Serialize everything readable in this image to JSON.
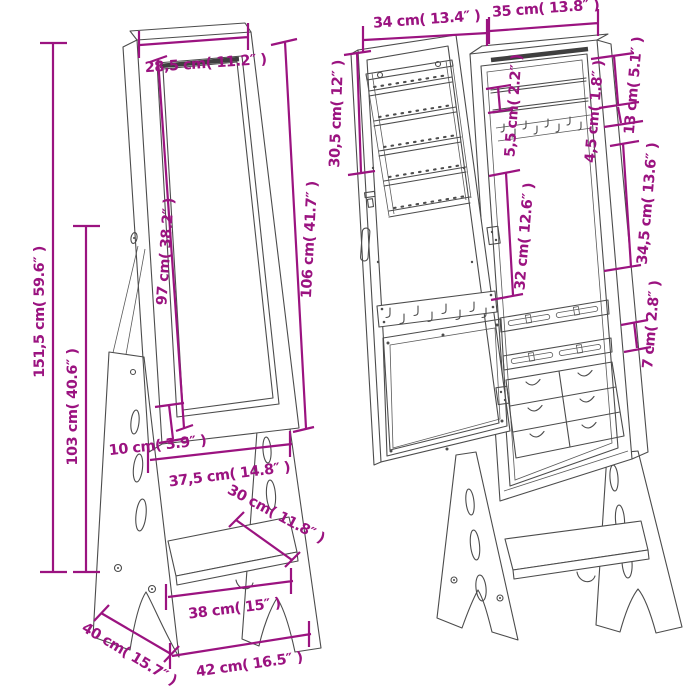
{
  "diagram": {
    "description": "Free-standing jewellery cabinet with mirror — dimension drawing, front view and open view",
    "colors": {
      "dimension": "#9b1380",
      "line": "#4c4c4c",
      "background": "#ffffff"
    },
    "front_view": {
      "top_width": "28,5 cm( 11.2″ )",
      "mirror_height": "97 cm( 38.2″ )",
      "cabinet_height": "106 cm( 41.7″ )",
      "total_height": "151,5 cm( 59.6″ )",
      "stand_height": "103 cm( 40.6″ )",
      "base_clearance": "10 cm( 3.9″ )",
      "lower_width": "37,5 cm( 14.8″ )",
      "shelf_depth": "30 cm( 11.8″ )",
      "shelf_width": "38 cm( 15″ )",
      "base_depth": "40 cm( 15.7″ )",
      "base_width": "42 cm( 16.5″ )"
    },
    "open_view": {
      "door_width": "34 cm( 13.4″ )",
      "cabinet_width": "35 cm( 13.8″ )",
      "door_rack_height": "30,5 cm( 12″ )",
      "shelf_spacing": "5,5 cm( 2.2″ )",
      "top_compartment_height": "13 cm( 5.1″ )",
      "hook_clearance": "4,5 cm( 1.8″ )",
      "middle_compartment_height": "34,5 cm( 13.6″ )",
      "inner_compartment_height": "32 cm( 12.6″ )",
      "drawer_height": "7 cm( 2.8″ )"
    }
  }
}
